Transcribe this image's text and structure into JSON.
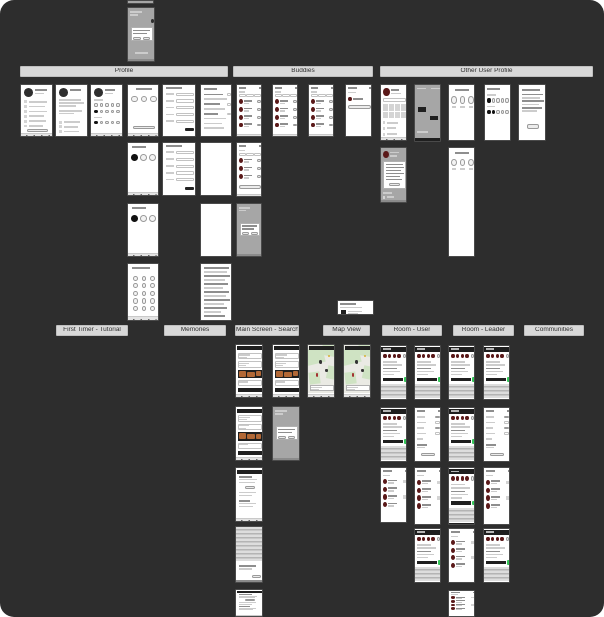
{
  "canvas": {
    "description": "Zoomed-out design canvas overview of a mobile app wireframe flow map",
    "width": 604,
    "height": 617
  },
  "colors": {
    "canvas_bg": "#2d2d2d",
    "header_bg": "#d8d8d8",
    "header_text": "#2e2e2e",
    "phone_bg": "#ffffff",
    "phone_frame": "#4a4a4a",
    "dark_bar": "#1f1f1f",
    "avatar_dark": "#2f2f2f",
    "avatar_red": "#5a1919",
    "accent_green": "#34c759",
    "accent_orange": "#b26836",
    "map_green": "#cfe3c3",
    "overlay_gray": "#a6a6a6"
  },
  "sections": [
    {
      "id": "profile",
      "label": "Profile",
      "x": 20,
      "y": 66,
      "w": 208,
      "h": 11
    },
    {
      "id": "buddies",
      "label": "Buddies",
      "x": 233,
      "y": 66,
      "w": 140,
      "h": 11
    },
    {
      "id": "other-user-profile",
      "label": "Other User Profile",
      "x": 380,
      "y": 66,
      "w": 213,
      "h": 11
    },
    {
      "id": "first-timer-tutorial",
      "label": "First Timer - Tutorial",
      "x": 56,
      "y": 325,
      "w": 72,
      "h": 11
    },
    {
      "id": "memories",
      "label": "Memories",
      "x": 164,
      "y": 325,
      "w": 62,
      "h": 11
    },
    {
      "id": "main-screen-search",
      "label": "Main Screen - Search",
      "x": 235,
      "y": 325,
      "w": 64,
      "h": 11
    },
    {
      "id": "map-view",
      "label": "Map View",
      "x": 323,
      "y": 325,
      "w": 47,
      "h": 11
    },
    {
      "id": "room-user",
      "label": "Room - User",
      "x": 382,
      "y": 325,
      "w": 60,
      "h": 11
    },
    {
      "id": "room-leader",
      "label": "Room - Leader",
      "x": 453,
      "y": 325,
      "w": 61,
      "h": 11
    },
    {
      "id": "communities",
      "label": "Communities",
      "x": 524,
      "y": 325,
      "w": 60,
      "h": 11
    }
  ],
  "phones": [
    {
      "x": 127,
      "y": 0,
      "w": 27,
      "h": 4,
      "variant": "strip",
      "section": "root"
    },
    {
      "x": 127,
      "y": 7,
      "w": 28,
      "h": 55,
      "variant": "gray-dialog",
      "section": "root"
    },
    {
      "x": 20,
      "y": 84,
      "w": 33,
      "h": 53,
      "variant": "profile-menu",
      "section": "profile"
    },
    {
      "x": 55,
      "y": 84,
      "w": 33,
      "h": 53,
      "variant": "profile-info",
      "section": "profile"
    },
    {
      "x": 90,
      "y": 84,
      "w": 33,
      "h": 53,
      "variant": "profile-interests",
      "section": "profile"
    },
    {
      "x": 127,
      "y": 84,
      "w": 32,
      "h": 53,
      "variant": "filters",
      "section": "profile"
    },
    {
      "x": 162,
      "y": 84,
      "w": 34,
      "h": 53,
      "variant": "form",
      "section": "profile"
    },
    {
      "x": 200,
      "y": 84,
      "w": 32,
      "h": 53,
      "variant": "text-list",
      "section": "profile"
    },
    {
      "x": 127,
      "y": 142,
      "w": 32,
      "h": 54,
      "variant": "filter-select",
      "section": "profile"
    },
    {
      "x": 162,
      "y": 142,
      "w": 34,
      "h": 54,
      "variant": "form",
      "section": "profile"
    },
    {
      "x": 200,
      "y": 142,
      "w": 32,
      "h": 54,
      "variant": "blank",
      "section": "profile"
    },
    {
      "x": 127,
      "y": 203,
      "w": 32,
      "h": 54,
      "variant": "filter-select",
      "section": "profile"
    },
    {
      "x": 200,
      "y": 203,
      "w": 32,
      "h": 54,
      "variant": "blank",
      "section": "profile"
    },
    {
      "x": 127,
      "y": 263,
      "w": 32,
      "h": 58,
      "variant": "circle-grid",
      "section": "profile"
    },
    {
      "x": 200,
      "y": 263,
      "w": 32,
      "h": 58,
      "variant": "text-dense",
      "section": "profile"
    },
    {
      "x": 236,
      "y": 84,
      "w": 26,
      "h": 53,
      "variant": "buddies-list",
      "section": "buddies"
    },
    {
      "x": 272,
      "y": 84,
      "w": 26,
      "h": 53,
      "variant": "buddies-list",
      "section": "buddies"
    },
    {
      "x": 308,
      "y": 84,
      "w": 26,
      "h": 53,
      "variant": "buddies-list",
      "section": "buddies"
    },
    {
      "x": 345,
      "y": 84,
      "w": 27,
      "h": 53,
      "variant": "buddies-invite",
      "section": "buddies"
    },
    {
      "x": 236,
      "y": 142,
      "w": 26,
      "h": 55,
      "variant": "buddies-list-btn",
      "section": "buddies"
    },
    {
      "x": 236,
      "y": 203,
      "w": 26,
      "h": 54,
      "variant": "gray-modal",
      "section": "buddies"
    },
    {
      "x": 380,
      "y": 84,
      "w": 27,
      "h": 57,
      "variant": "other-profile",
      "section": "other-user-profile"
    },
    {
      "x": 414,
      "y": 84,
      "w": 27,
      "h": 58,
      "variant": "photo-overlay",
      "section": "other-user-profile"
    },
    {
      "x": 448,
      "y": 84,
      "w": 27,
      "h": 57,
      "variant": "mute-circles",
      "section": "other-user-profile"
    },
    {
      "x": 484,
      "y": 84,
      "w": 27,
      "h": 57,
      "variant": "badges",
      "section": "other-user-profile"
    },
    {
      "x": 518,
      "y": 84,
      "w": 28,
      "h": 57,
      "variant": "text-button",
      "section": "other-user-profile"
    },
    {
      "x": 380,
      "y": 147,
      "w": 27,
      "h": 56,
      "variant": "gray-note",
      "section": "other-user-profile"
    },
    {
      "x": 448,
      "y": 147,
      "w": 27,
      "h": 110,
      "variant": "mute-tall",
      "section": "other-user-profile"
    },
    {
      "x": 235,
      "y": 344,
      "w": 28,
      "h": 54,
      "variant": "search-feed",
      "section": "main-screen-search"
    },
    {
      "x": 272,
      "y": 344,
      "w": 28,
      "h": 54,
      "variant": "search-feed",
      "section": "main-screen-search"
    },
    {
      "x": 235,
      "y": 406,
      "w": 28,
      "h": 55,
      "variant": "search-feed",
      "section": "main-screen-search"
    },
    {
      "x": 272,
      "y": 406,
      "w": 28,
      "h": 55,
      "variant": "gray-modal",
      "section": "main-screen-search"
    },
    {
      "x": 235,
      "y": 467,
      "w": 28,
      "h": 55,
      "variant": "search-text",
      "section": "main-screen-search"
    },
    {
      "x": 235,
      "y": 526,
      "w": 28,
      "h": 57,
      "variant": "keyboard-overlay",
      "section": "main-screen-search"
    },
    {
      "x": 235,
      "y": 589,
      "w": 28,
      "h": 28,
      "variant": "search-text",
      "section": "main-screen-search"
    },
    {
      "x": 337,
      "y": 300,
      "w": 37,
      "h": 15,
      "variant": "notification-widget",
      "section": "map-view"
    },
    {
      "x": 307,
      "y": 344,
      "w": 28,
      "h": 54,
      "variant": "map",
      "section": "map-view"
    },
    {
      "x": 343,
      "y": 344,
      "w": 28,
      "h": 54,
      "variant": "map",
      "section": "map-view"
    },
    {
      "x": 380,
      "y": 345,
      "w": 27,
      "h": 55,
      "variant": "chat",
      "section": "room-user"
    },
    {
      "x": 414,
      "y": 345,
      "w": 27,
      "h": 55,
      "variant": "chat",
      "section": "room-user"
    },
    {
      "x": 380,
      "y": 407,
      "w": 27,
      "h": 55,
      "variant": "chat",
      "section": "room-user"
    },
    {
      "x": 414,
      "y": 407,
      "w": 27,
      "h": 55,
      "variant": "room-settings",
      "section": "room-user"
    },
    {
      "x": 380,
      "y": 467,
      "w": 27,
      "h": 56,
      "variant": "room-list",
      "section": "room-user"
    },
    {
      "x": 414,
      "y": 467,
      "w": 27,
      "h": 58,
      "variant": "room-list",
      "section": "room-user"
    },
    {
      "x": 414,
      "y": 528,
      "w": 27,
      "h": 55,
      "variant": "chat",
      "section": "room-user"
    },
    {
      "x": 448,
      "y": 345,
      "w": 27,
      "h": 55,
      "variant": "chat",
      "section": "room-leader"
    },
    {
      "x": 483,
      "y": 345,
      "w": 27,
      "h": 55,
      "variant": "chat",
      "section": "room-leader"
    },
    {
      "x": 448,
      "y": 407,
      "w": 27,
      "h": 55,
      "variant": "chat",
      "section": "room-leader"
    },
    {
      "x": 483,
      "y": 407,
      "w": 27,
      "h": 55,
      "variant": "room-settings",
      "section": "room-leader"
    },
    {
      "x": 448,
      "y": 467,
      "w": 27,
      "h": 58,
      "variant": "chat",
      "section": "room-leader"
    },
    {
      "x": 483,
      "y": 467,
      "w": 27,
      "h": 58,
      "variant": "room-list",
      "section": "room-leader"
    },
    {
      "x": 448,
      "y": 528,
      "w": 27,
      "h": 55,
      "variant": "room-list",
      "section": "room-leader"
    },
    {
      "x": 483,
      "y": 528,
      "w": 27,
      "h": 55,
      "variant": "chat",
      "section": "room-leader"
    },
    {
      "x": 448,
      "y": 590,
      "w": 27,
      "h": 27,
      "variant": "room-list",
      "section": "room-leader"
    }
  ]
}
